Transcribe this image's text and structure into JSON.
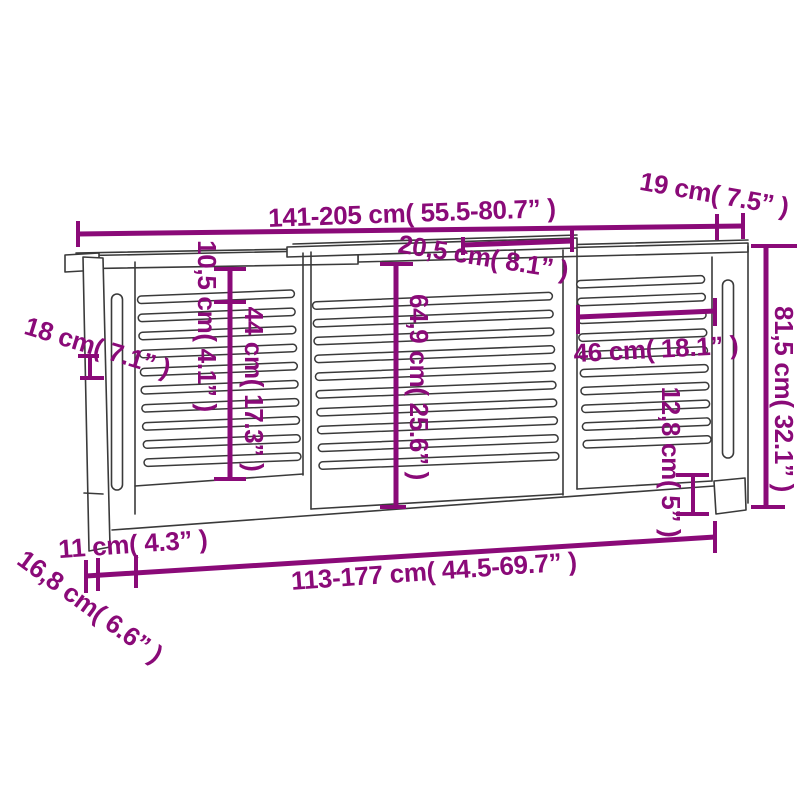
{
  "style": {
    "accent_color": "#8a0a78",
    "line_art_color": "#3a3a3a",
    "background": "#ffffff"
  },
  "diagram": {
    "type": "product-dimension-line-drawing",
    "subject": "extendable slatted radiator cover",
    "labels": {
      "overall_width": "141-205 cm( 55.5-80.7” )",
      "top_shelf_depth": "19 cm( 7.5” )",
      "top_overlap_width": "20,5 cm( 8.1” )",
      "top_rail_height": "10,5 cm( 4.1” )",
      "side_section_height": "44 cm( 17.3” )",
      "center_section_height": "64,9 cm( 25.6” )",
      "side_depth": "18 cm( 7.1” )",
      "overall_height": "81,5 cm( 32.1” )",
      "right_section_width": "46 cm( 18.1” )",
      "bottom_clearance_height": "12,8 cm( 5” )",
      "foot_width": "11 cm( 4.3” )",
      "base_depth": "16,8 cm( 6.6” )",
      "inner_width": "113-177 cm( 44.5-69.7” )"
    }
  }
}
